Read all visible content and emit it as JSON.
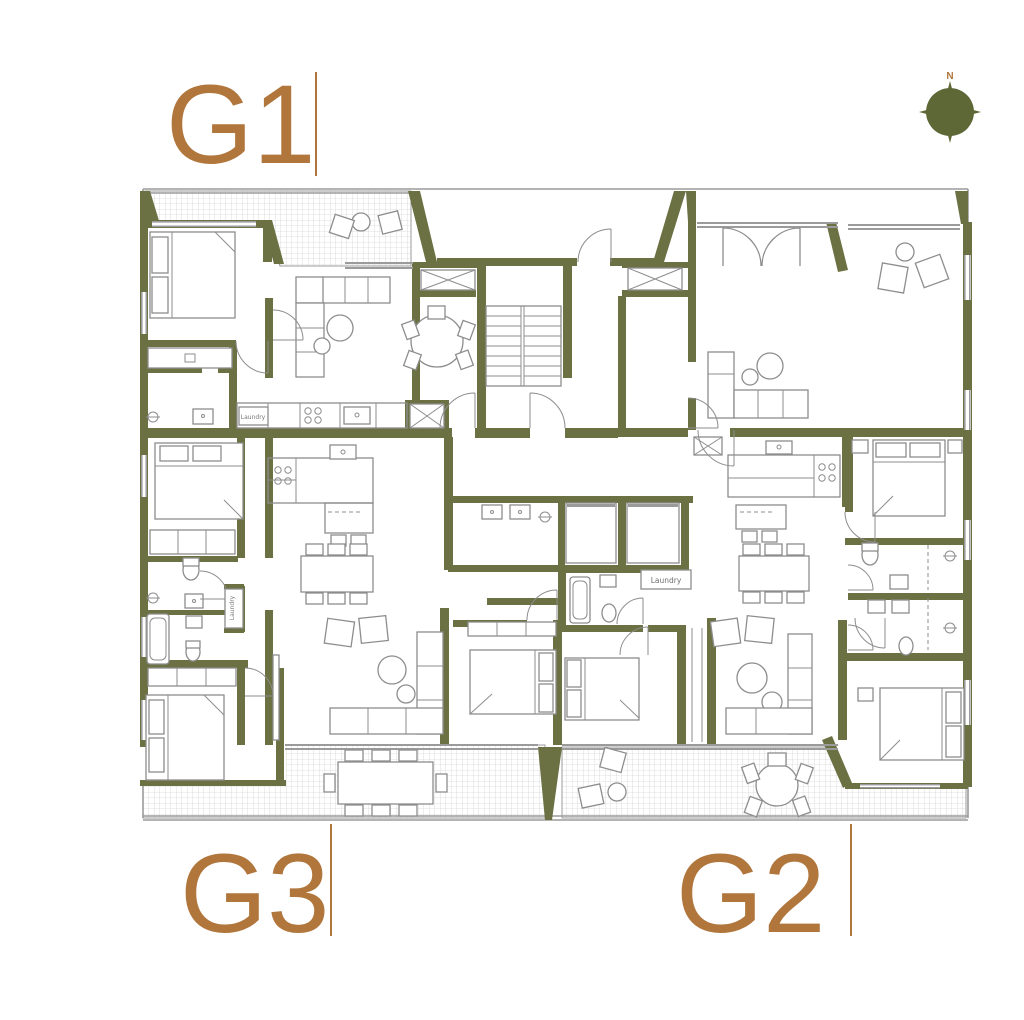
{
  "colors": {
    "wall": "#6b7143",
    "accent": "#b0763c",
    "furn": "#8d8d8d",
    "gray2": "#9b9b9b",
    "hatchline": "#d6d6d6"
  },
  "units": {
    "g1": "G1",
    "g2": "G2",
    "g3": "G3"
  },
  "compass": {
    "north_label": "N"
  },
  "labels": {
    "laundry_g1": "Laundry",
    "laundry_center": "Laundry",
    "laundry_g3": "Laundry"
  }
}
